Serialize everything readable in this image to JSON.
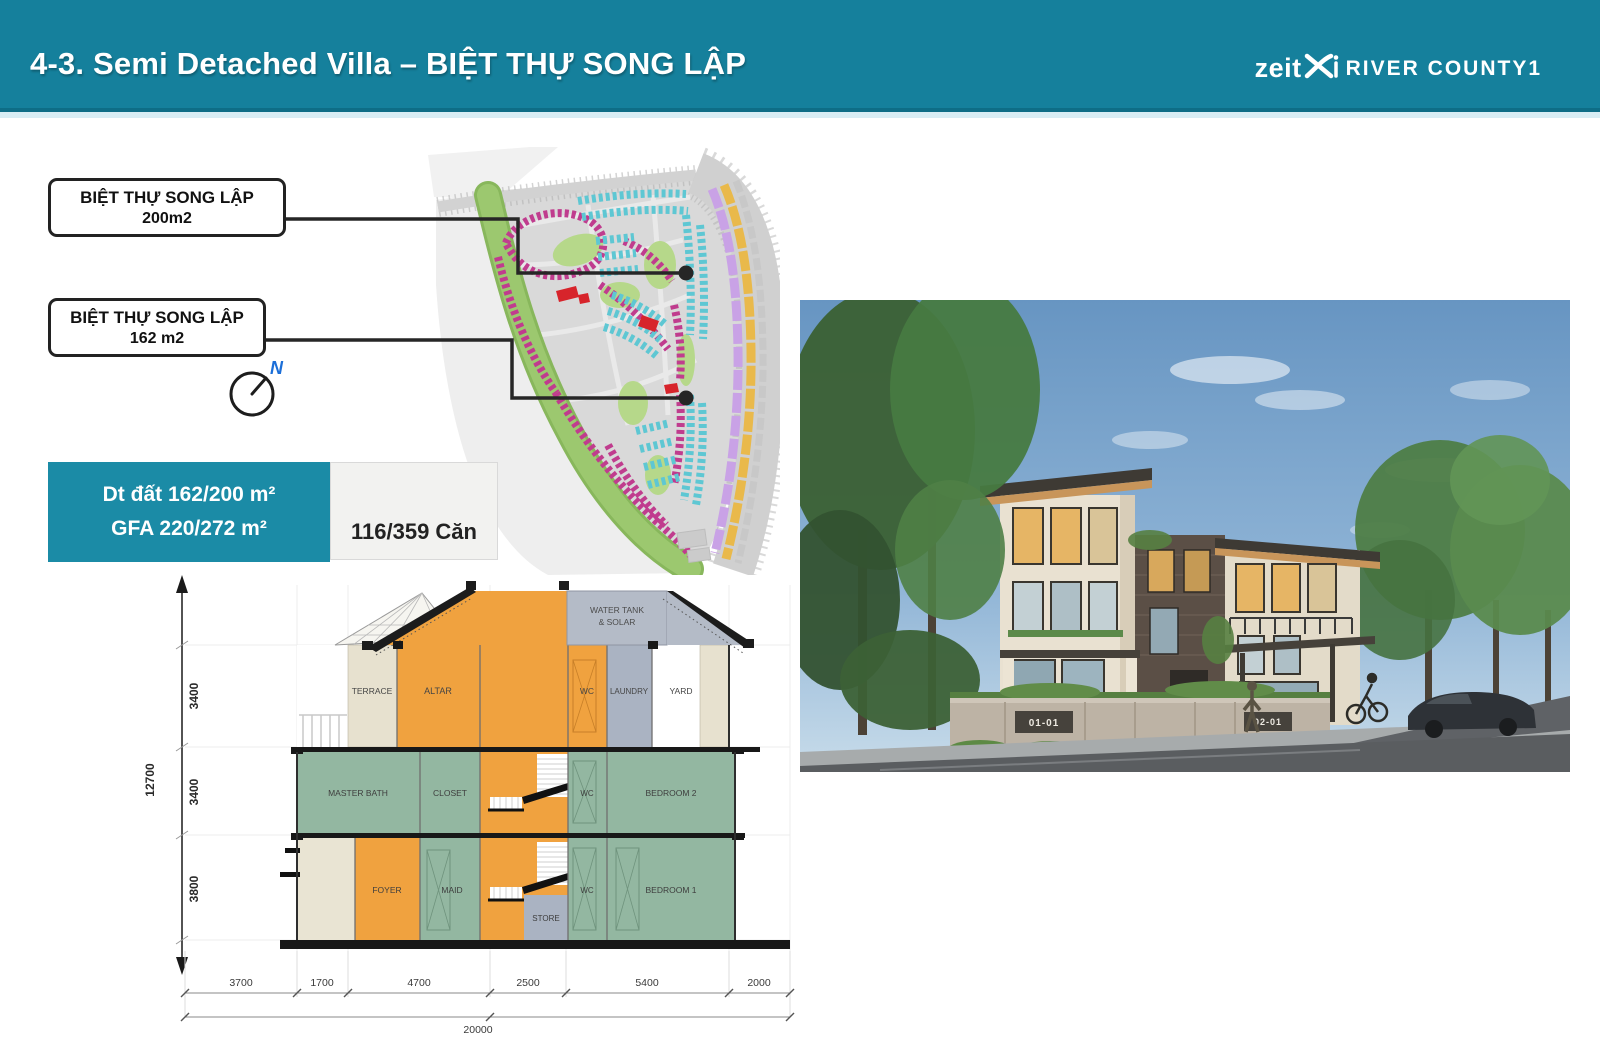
{
  "header": {
    "title": "4-3. Semi Detached Villa – BIỆT THỰ SONG LẬP",
    "logo": {
      "brand": "zeit",
      "project": "RIVER COUNTY1"
    }
  },
  "callouts": [
    {
      "line1": "BIỆT THỰ SONG LẬP",
      "line2": "200m2"
    },
    {
      "line1": "BIỆT THỰ SONG LẬP",
      "line2": "162 m2"
    }
  ],
  "compass": {
    "north": "N"
  },
  "info_panel": {
    "land_area": "Dt đất 162/200 m²",
    "gfa": "GFA 220/272 m²",
    "units": "116/359 Căn"
  },
  "section": {
    "labels": {
      "water_tank_1": "WATER TANK",
      "water_tank_2": "& SOLAR",
      "terrace": "TERRACE",
      "altar": "ALTAR",
      "wc3": "WC",
      "laundry": "LAUNDRY",
      "yard": "YARD",
      "master_bath": "MASTER BATH",
      "closet": "CLOSET",
      "wc2": "WC",
      "bedroom2": "BEDROOM 2",
      "foyer": "FOYER",
      "maid": "MAID",
      "store": "STORE",
      "wc1": "WC",
      "bedroom1": "BEDROOM 1"
    },
    "dims_floors": [
      "3400",
      "3400",
      "3800"
    ],
    "dim_total_height": "12700",
    "dims_width": [
      "3700",
      "1700",
      "4700",
      "2500",
      "5400",
      "2000"
    ],
    "dim_total_width": "20000"
  },
  "photo": {
    "gate_signs": [
      "01-01",
      "02-01"
    ]
  },
  "colors": {
    "header_teal": "#15809c",
    "info_teal": "#1b8ba6",
    "section_orange": "#f0a23f",
    "section_green": "#93b7a1",
    "section_gray": "#aab3c2",
    "map_magenta": "#c03c8e",
    "map_cyan": "#5ec7d3",
    "map_purple": "#c9a2e6",
    "map_orange": "#e9b94b",
    "map_green": "#9cc86f",
    "highlight_red": "#d7242b",
    "north_blue": "#1c6fd8"
  }
}
